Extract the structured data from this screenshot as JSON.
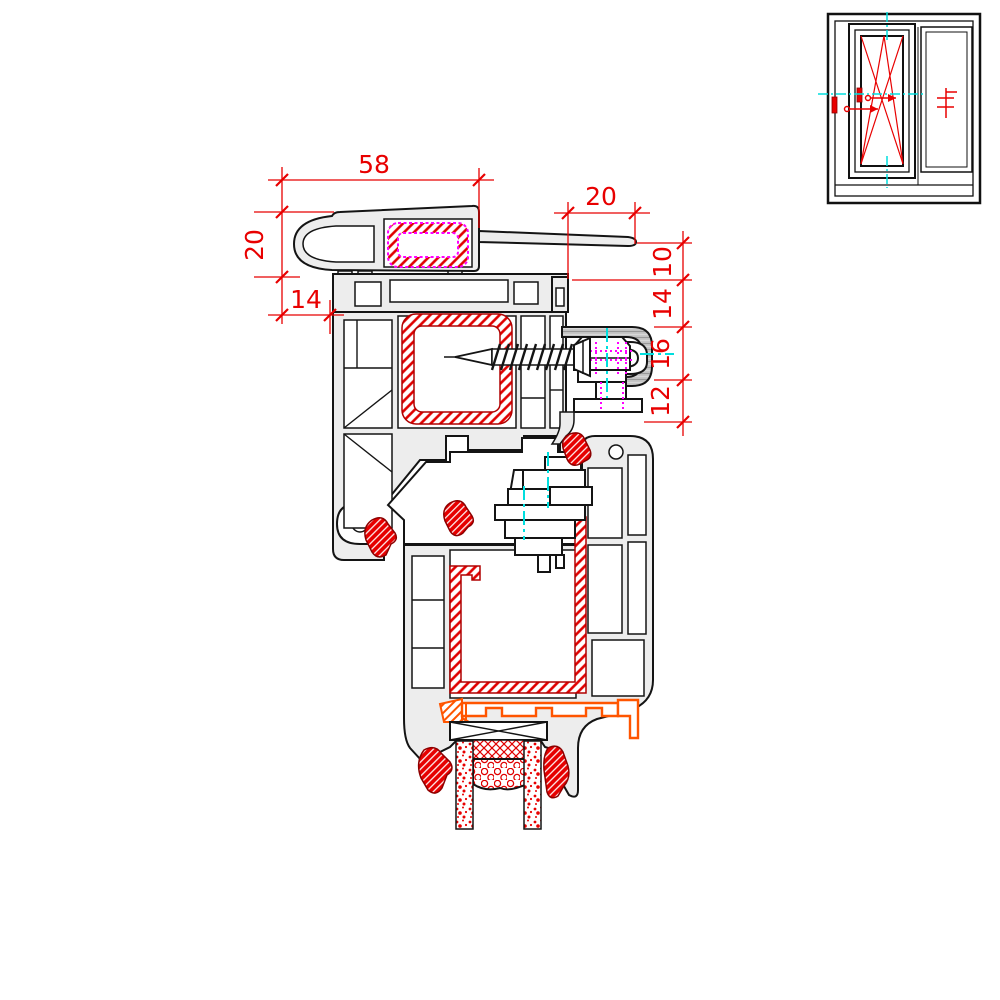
{
  "drawing": {
    "type": "window-frame-cross-section",
    "dims": {
      "top_width": "58",
      "addon_height": "20",
      "addon_offset": "14",
      "flap_width": "20",
      "chain": [
        "10",
        "14",
        "16",
        "12"
      ]
    },
    "colors": {
      "dimension": "#e80000",
      "steel_hatch": "#e00000",
      "reinforcement_outline": "#ff00ff",
      "centerline": "#00dede",
      "gasket": "#e80000",
      "glazing_bridge": "#ff5500",
      "profile_fill": "#ededed",
      "outline": "#141414"
    },
    "icons": {
      "window_schematic": "tilt-turn-window-elevation",
      "screw": "fixing-screw",
      "roller": "hardware-roller-block",
      "glass": "insulated-glass-unit"
    }
  }
}
